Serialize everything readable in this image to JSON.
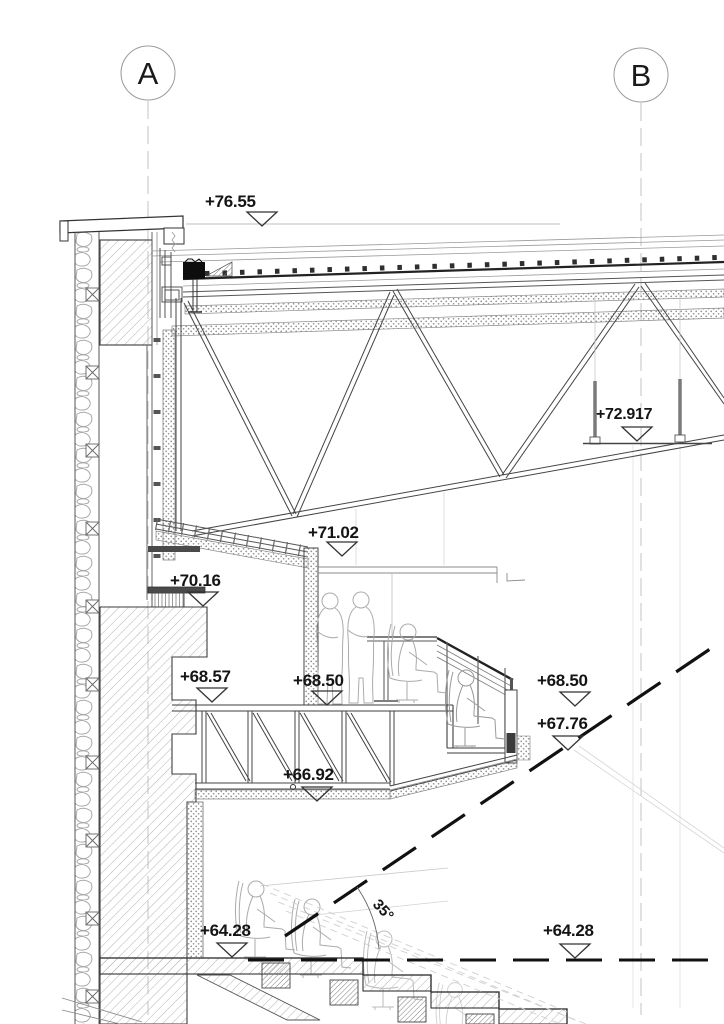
{
  "drawing": {
    "grid": {
      "a": "A",
      "b": "B"
    },
    "levels": {
      "roof_parapet": "+76.55",
      "catwalk": "+72.917",
      "truss_bottom": "+71.02",
      "wall_ledge": "+70.16",
      "corridor_floor": "+68.57",
      "suite_floor_mid": "+68.50",
      "suite_floor_right": "+68.50",
      "suite_front": "+67.76",
      "floor_truss_soffit": "+66.92",
      "tier_left": "+64.28",
      "tier_right": "+64.28"
    },
    "angle_label": "35°",
    "colors": {
      "line_dark": "#3a3a3a",
      "line_mid": "#8a8a8a",
      "line_light": "#c9c9c9",
      "hatch": "#b3b3b3",
      "heavy_dash": "#111111",
      "background": "#ffffff"
    }
  }
}
